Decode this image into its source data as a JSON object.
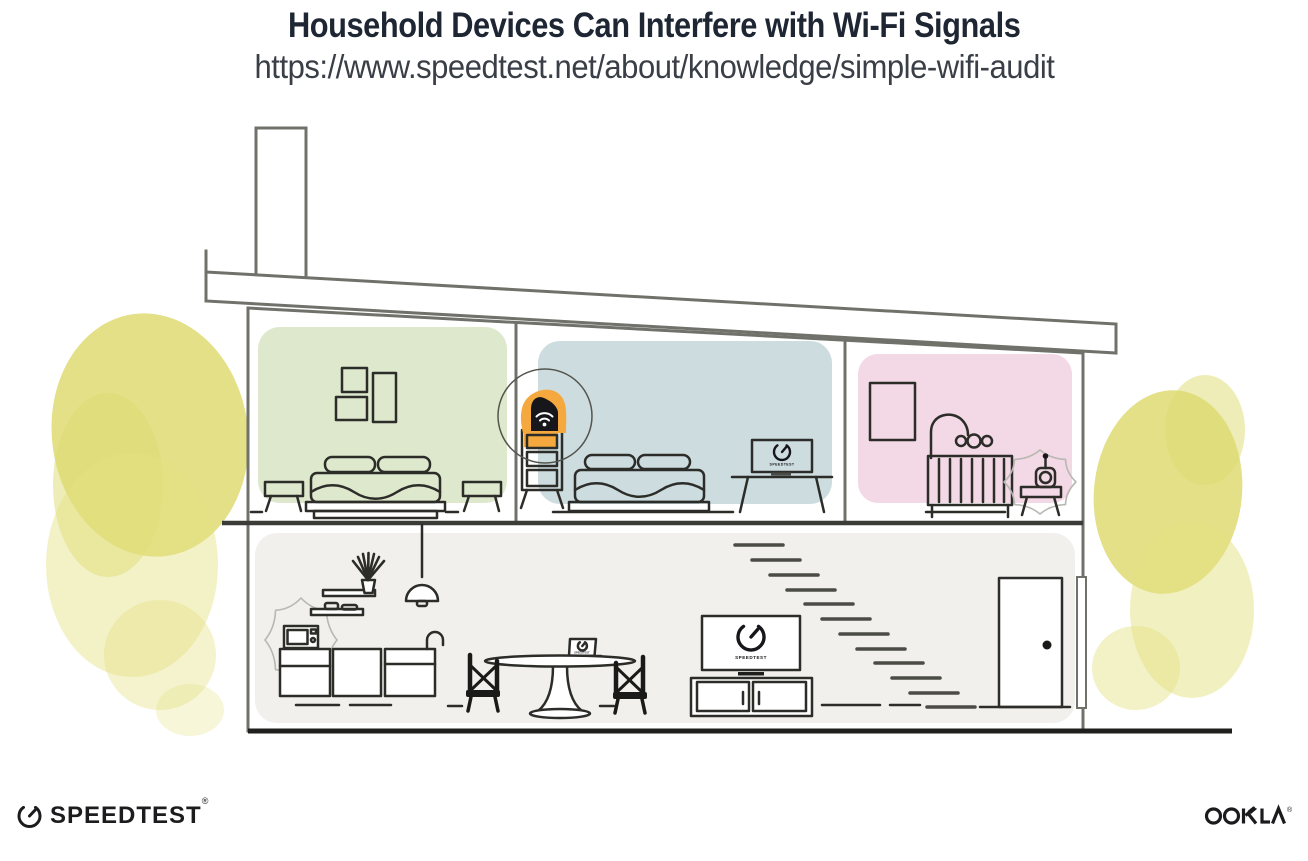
{
  "header": {
    "title": "Household Devices Can Interfere with Wi-Fi Signals",
    "url": "https://www.speedtest.net/about/knowledge/simple-wifi-audit"
  },
  "branding": {
    "speedtest": {
      "name": "SPEEDTEST",
      "trademark": "®"
    },
    "ookla": {
      "name": "OOKLA",
      "trademark": "®"
    }
  },
  "screens": {
    "bedroom_monitor_label": "SPEEDTEST",
    "dining_laptop_label": "SPEEDTEST",
    "living_tv_label": "SPEEDTEST"
  },
  "colors": {
    "room_green": "#dde8cc",
    "room_blue": "#ccdcdf",
    "room_pink": "#f3d8e5",
    "floor_gray": "#f1f0ed",
    "accent_orange": "#f4a83e",
    "tree_yellow": "#dedb72",
    "tree_yellow_light": "#e4e181",
    "router_black": "#17171b"
  },
  "illustration": {
    "alt": "Cross-section of a two-story house: Wi-Fi router highlighted in an upstairs bedroom; microwave in kitchen and baby monitor in nursery shown emitting interference; laptops and TV display the Speedtest gauge",
    "devices": [
      {
        "name": "wifi-router",
        "location": "upstairs middle bedroom",
        "highlighted": true
      },
      {
        "name": "microwave",
        "location": "kitchen",
        "interference": true
      },
      {
        "name": "baby-monitor",
        "location": "nursery",
        "interference": true
      },
      {
        "name": "desktop-monitor",
        "location": "upstairs middle bedroom",
        "screen": "SPEEDTEST"
      },
      {
        "name": "laptop",
        "location": "dining table",
        "screen": "SPEEDTEST"
      },
      {
        "name": "television",
        "location": "living room",
        "screen": "SPEEDTEST"
      }
    ]
  }
}
